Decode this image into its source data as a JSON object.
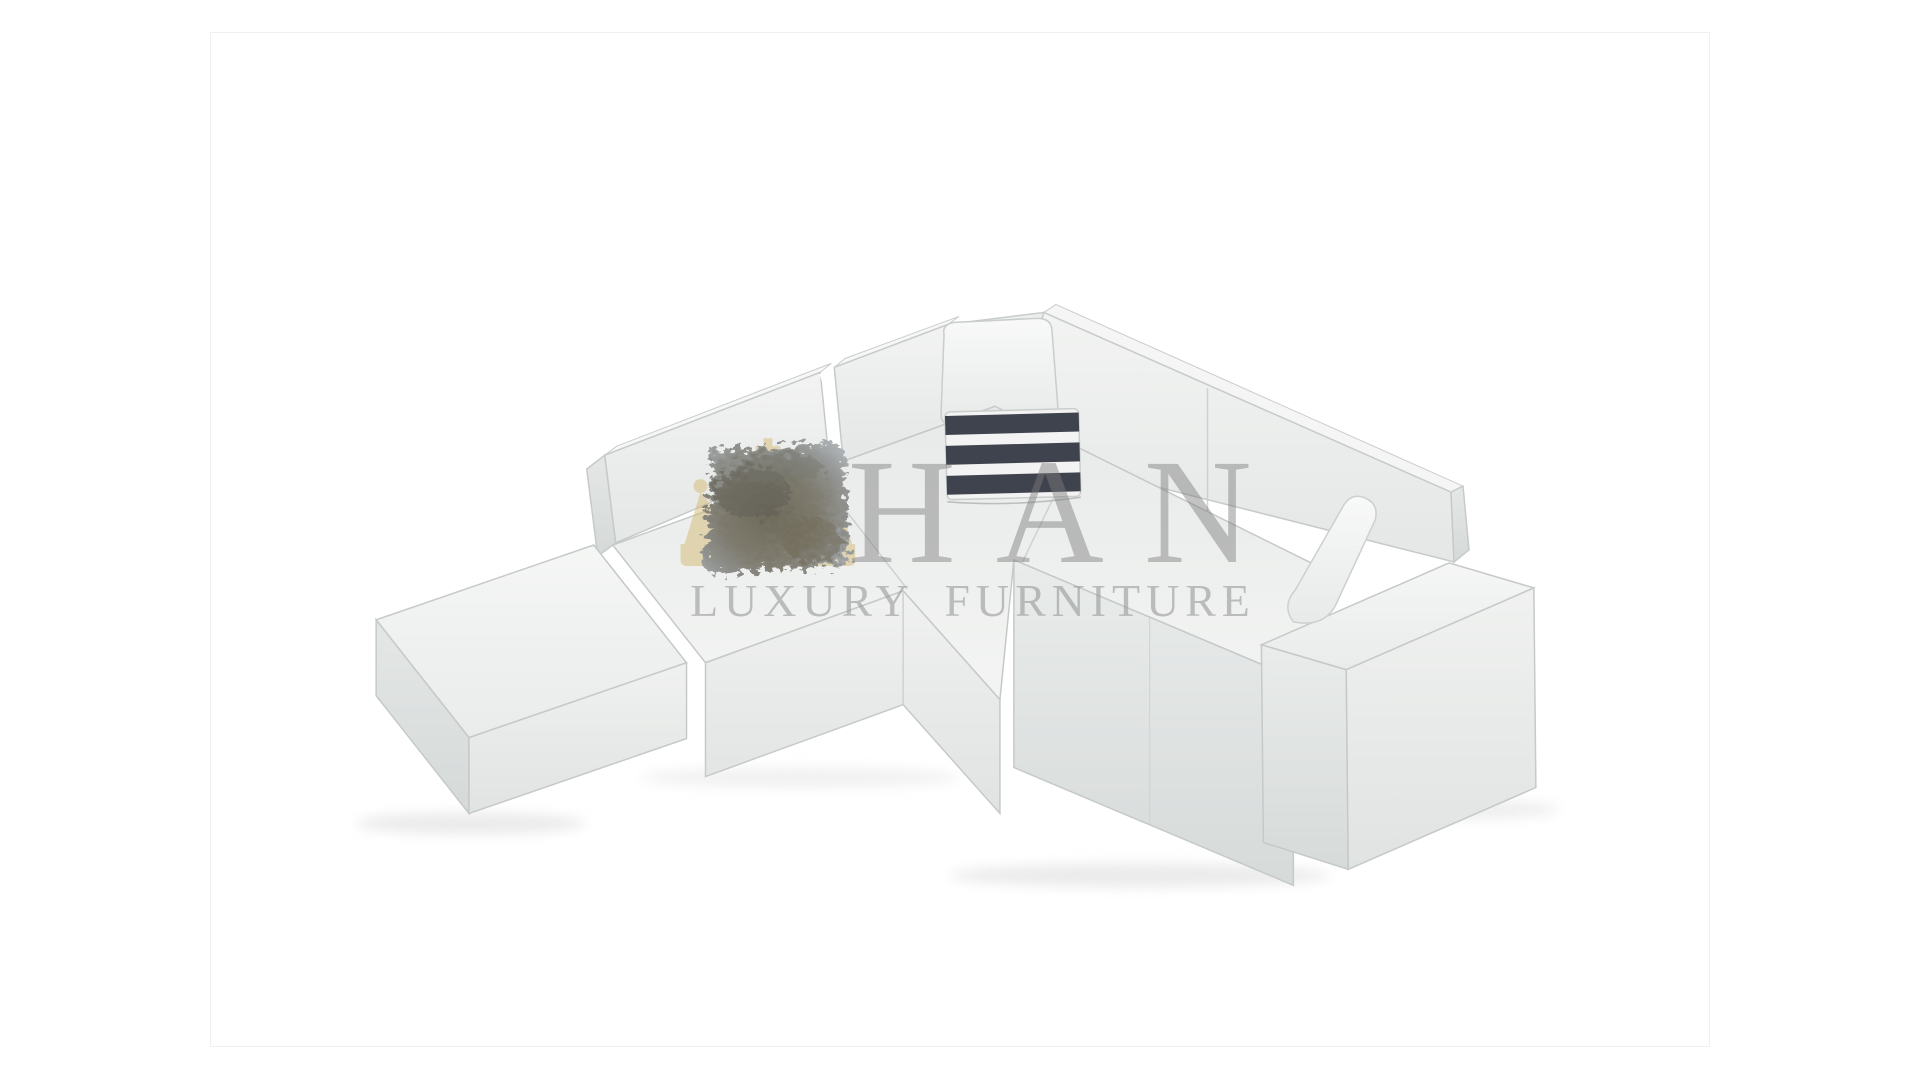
{
  "image": {
    "type": "product-photo",
    "subject": "modular L-shaped sectional sofa, top-front view",
    "background_color": "#ffffff",
    "frame_border_color": "#f0f0f0"
  },
  "watermark": {
    "brand": "HAN",
    "tagline": "LUXURY FURNITURE",
    "brand_color": "#7d7d7d",
    "tagline_color": "#9b9b9b",
    "crown_color": "#d4ba74"
  },
  "sofa": {
    "fabric_color": "#edefee",
    "fabric_shadow_color": "#d6dad9",
    "piping_color": "#c5c9c8",
    "pieces": [
      "ottoman-module",
      "left-seat-modules",
      "left-backrest-modules",
      "corner-module",
      "right-seat-module",
      "right-backrest-modules",
      "right-arm-module"
    ],
    "pillows": [
      {
        "name": "fur-pillow",
        "colors": [
          "#9aa0a5",
          "#6f6a58"
        ]
      },
      {
        "name": "striped-pillow",
        "colors": [
          "#3f434e",
          "#f2f3f2"
        ],
        "dark_stripes": 3
      },
      {
        "name": "corner-white-pillow",
        "colors": [
          "#f4f5f4"
        ]
      },
      {
        "name": "bolster-white-pillow",
        "colors": [
          "#f4f5f4"
        ]
      }
    ]
  }
}
